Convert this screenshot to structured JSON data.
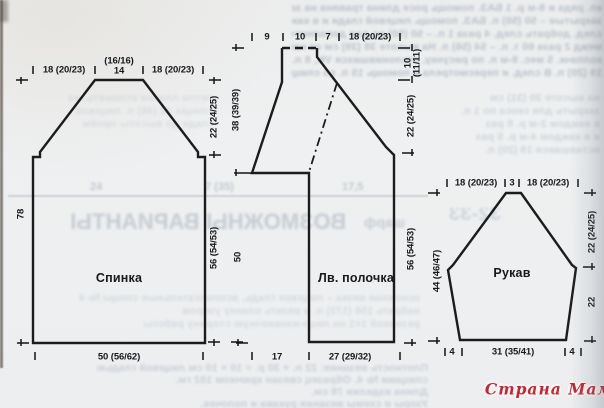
{
  "document": {
    "kind": "knitting-pattern-schematic-scan"
  },
  "colors": {
    "paper": "#eef0f1",
    "line": "#1c1c1c",
    "watermark_red": "#c9252f",
    "bleed_text": "#b9c1ca"
  },
  "watermark": {
    "text": "Страна Мам"
  },
  "pieces": {
    "back": {
      "title": "Спинка",
      "m": {
        "shoulder_left": "18 (20/23)",
        "neck_alt": "(16/16)",
        "neck": "14",
        "shoulder_right": "18 (20/23)",
        "height_total": "78",
        "armhole": "22 (24/25)",
        "side": "56 (54/53)",
        "hem": "50 (56/62)"
      }
    },
    "front": {
      "title": "Лв. полочка",
      "m": {
        "seg1": "9",
        "seg2": "10",
        "seg3": "7",
        "seg4": "18 (20/23)",
        "left_upper": "38 (39/39)",
        "left_lower": "50",
        "right_top_a": "10",
        "right_top_b": "(11/11)",
        "right_mid": "22 (24/25)",
        "right_lower": "56 (54/53)",
        "hem_left": "17",
        "hem": "27 (29/32)"
      }
    },
    "sleeve": {
      "title": "Рукав",
      "m": {
        "cap_left": "18 (20/23)",
        "cap_top": "3",
        "cap_right": "18 (20/23)",
        "left": "44 (46/47)",
        "right_upper": "22 (24/25)",
        "right_lower": "22",
        "hem_left": "4",
        "hem": "31 (35/41)",
        "hem_right": "4"
      }
    }
  },
  "bleed": {
    "headline": "ВОЗМОЖНЫ ВАРИАНТЫ",
    "headline_small": "шарф",
    "digits": "32-33",
    "numbers": [
      "24",
      "7 (35)",
      "17,5"
    ],
    "top_lines": [
      "кп. ряда в 8-м р. 1 БАЗ. помощь росе длина травяна на завязкам 49 (47) ед.",
      "закрытые – 50 (50) п. БАЗ. помощь лицевой глади и в каждом след. 10-м р.",
      "след. добрать след. 4 раза 1 п. – 50 (50) рс для дополнительных п. Закрыть",
      "межд 2 раза 60 т. п. – 54 (56) п. На высоте 38 (39) см от наборного края",
      "колпачк. 5 мес. 8-м п. по рисунку, отклонившихся VK, 8 п. 1 В ряд и",
      "19 (20) п. В след. и пересмотрела и помощь 15 п. со спицы В. одном п."
    ],
    "side_lines": [
      "на высоте 30 (31) см",
      "закрыть для скоса по 1 п.",
      "в каждом 2-м р. 8 раз",
      "и в каждом 4-м р. 5 раз",
      "оставшиеся 19 (20) п."
    ],
    "mid_lines": [
      "петли планки отложить, на",
      "спицах 42 (46) п. лицевой",
      "глади до высоты пройм"
    ],
    "lower_lines": [
      "основная вязка – лицевая гладь, вспомогательные спицы № 4",
      "набрать 158 (172) п. и вязать планку узором",
      "резинкой 1×1 на лицо-изнаночную сторону работы"
    ],
    "bottom_lines": [
      "Плотность вязания: 22 п. × 30 р. = 10 × 10 см лицевой гладью",
      "спицами № 4. Образец связан крючком 102 гм.",
      "Длина изделия 78 см.",
      "Узоры и схемы вязания рукава и полочек."
    ]
  }
}
